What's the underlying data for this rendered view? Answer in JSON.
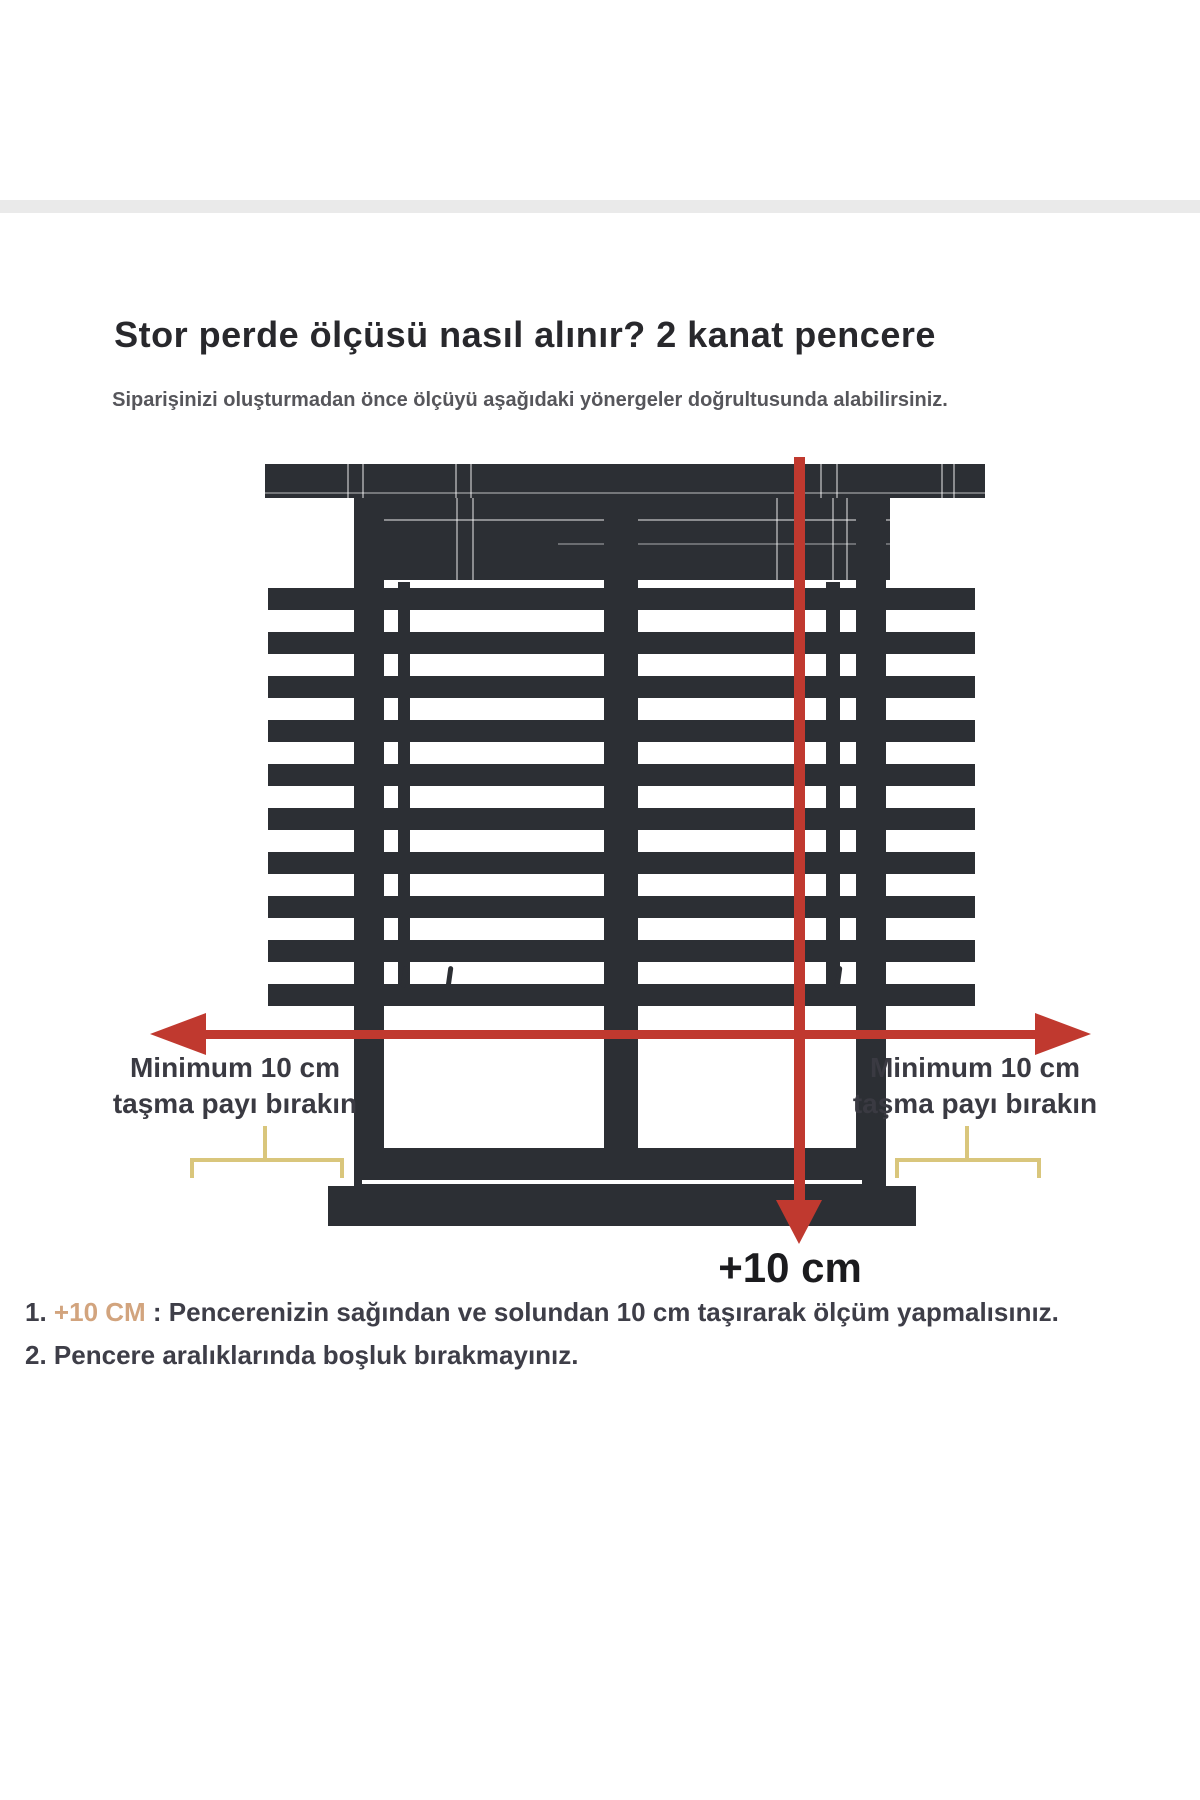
{
  "header": {
    "title": "Stor perde ölçüsü nasıl alınır? 2 kanat pencere",
    "subtitle": "Siparişinizi oluşturmadan önce ölçüyü aşağıdaki yönergeler doğrultusunda alabilirsiniz."
  },
  "diagram": {
    "left_overhang_label": {
      "line1": "Minimum 10 cm",
      "line2": "taşma payı bırakın"
    },
    "right_overhang_label": {
      "line1": "Minimum 10 cm",
      "line2": "taşma payı bırakın"
    },
    "height_extension_label": "+10 cm"
  },
  "notes": {
    "item1": {
      "number": "1. ",
      "highlight": "+10 CM",
      "text": " : Pencerenizin sağından ve solundan 10 cm taşırarak ölçüm yapmalısınız."
    },
    "item2": {
      "number": "2. ",
      "text": "Pencere aralıklarında boşluk bırakmayınız."
    }
  },
  "colors": {
    "window_dark": "#2c2f34",
    "measure_red": "#c0392f",
    "bracket_yellow": "#d9c67c",
    "highlight_tan": "#d2a47e"
  }
}
